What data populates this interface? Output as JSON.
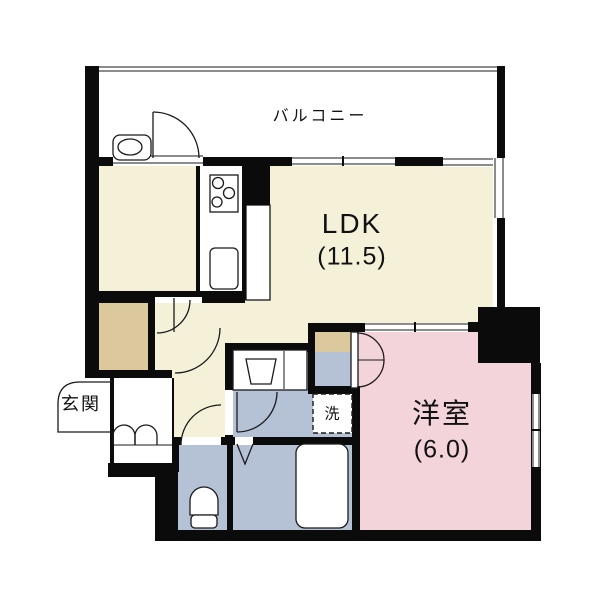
{
  "floor_plan": {
    "rooms": {
      "balcony": {
        "label": "バルコニー"
      },
      "ldk": {
        "label": "LDK",
        "size": "(11.5)"
      },
      "western_room": {
        "label": "洋室",
        "size": "(6.0)"
      },
      "entrance": {
        "label": "玄関"
      },
      "washer": {
        "label": "洗"
      }
    },
    "colors": {
      "room_cream": "#f5f1d8",
      "closet_tan": "#dbc89d",
      "western_pink": "#f2d4da",
      "wet_blue": "#b5c2d6",
      "floor_white": "#ffffff",
      "wall_black": "#0b0b0b"
    }
  }
}
